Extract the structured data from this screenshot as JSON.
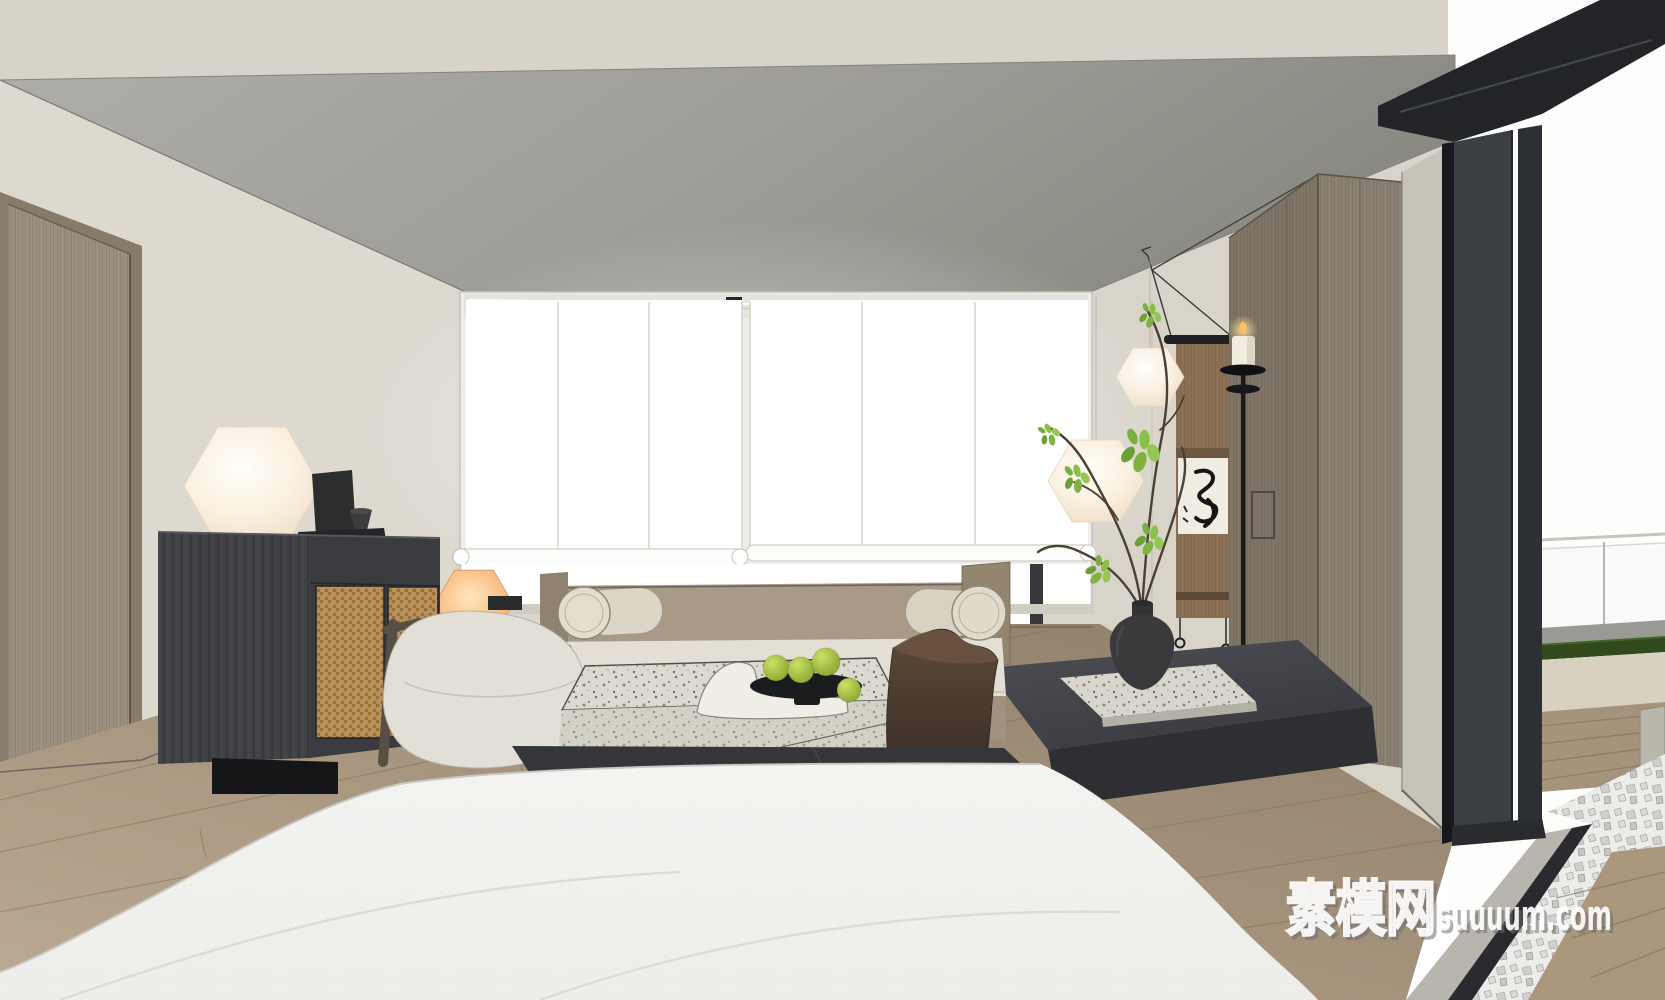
{
  "meta": {
    "title": "Minimalist Japandi bedroom - 3D interior render",
    "scene_type": "3d_render_screenshot"
  },
  "watermark": {
    "cn": "素模网",
    "latin": "suuuum.com"
  },
  "palette": {
    "wall_beige": "#dbd7cd",
    "ceiling_gray": "#a2a19c",
    "floor_wood": "#a5937e",
    "cabinet_dark": "#3a3c3f",
    "rattan": "#c49c63",
    "lamp_warm_white": "#f7eedd",
    "lamp_orange": "#f4b273",
    "fruit_green": "#9cb83d",
    "platform_charcoal": "#3a3b40",
    "duvet_white": "#f1f1ef",
    "door_frame_black": "#26282b",
    "exterior_grass": "#31491d",
    "scroll_brown": "#8b7055"
  },
  "objects": [
    "entry door",
    "black oak floating sideboard with cane-weave doors",
    "hexagonal white table lamp",
    "hexagonal orange table lamp",
    "lounge armchair",
    "window with white roller blinds",
    "daybed with bolster cushions",
    "terrazzo coffee table with wave sculpture",
    "black dish with green fruit",
    "tree-stump side stool",
    "charcoal stone platform with terrazzo slab",
    "black vase with branches",
    "two hexagonal pendant lamps",
    "hanging calligraphy scroll",
    "iron floor candle stand with lit candle",
    "wood wardrobe",
    "black framed sliding glass door",
    "terrace with glass railing, lawn strip, wood deck and pebbles",
    "white bed in foreground"
  ]
}
